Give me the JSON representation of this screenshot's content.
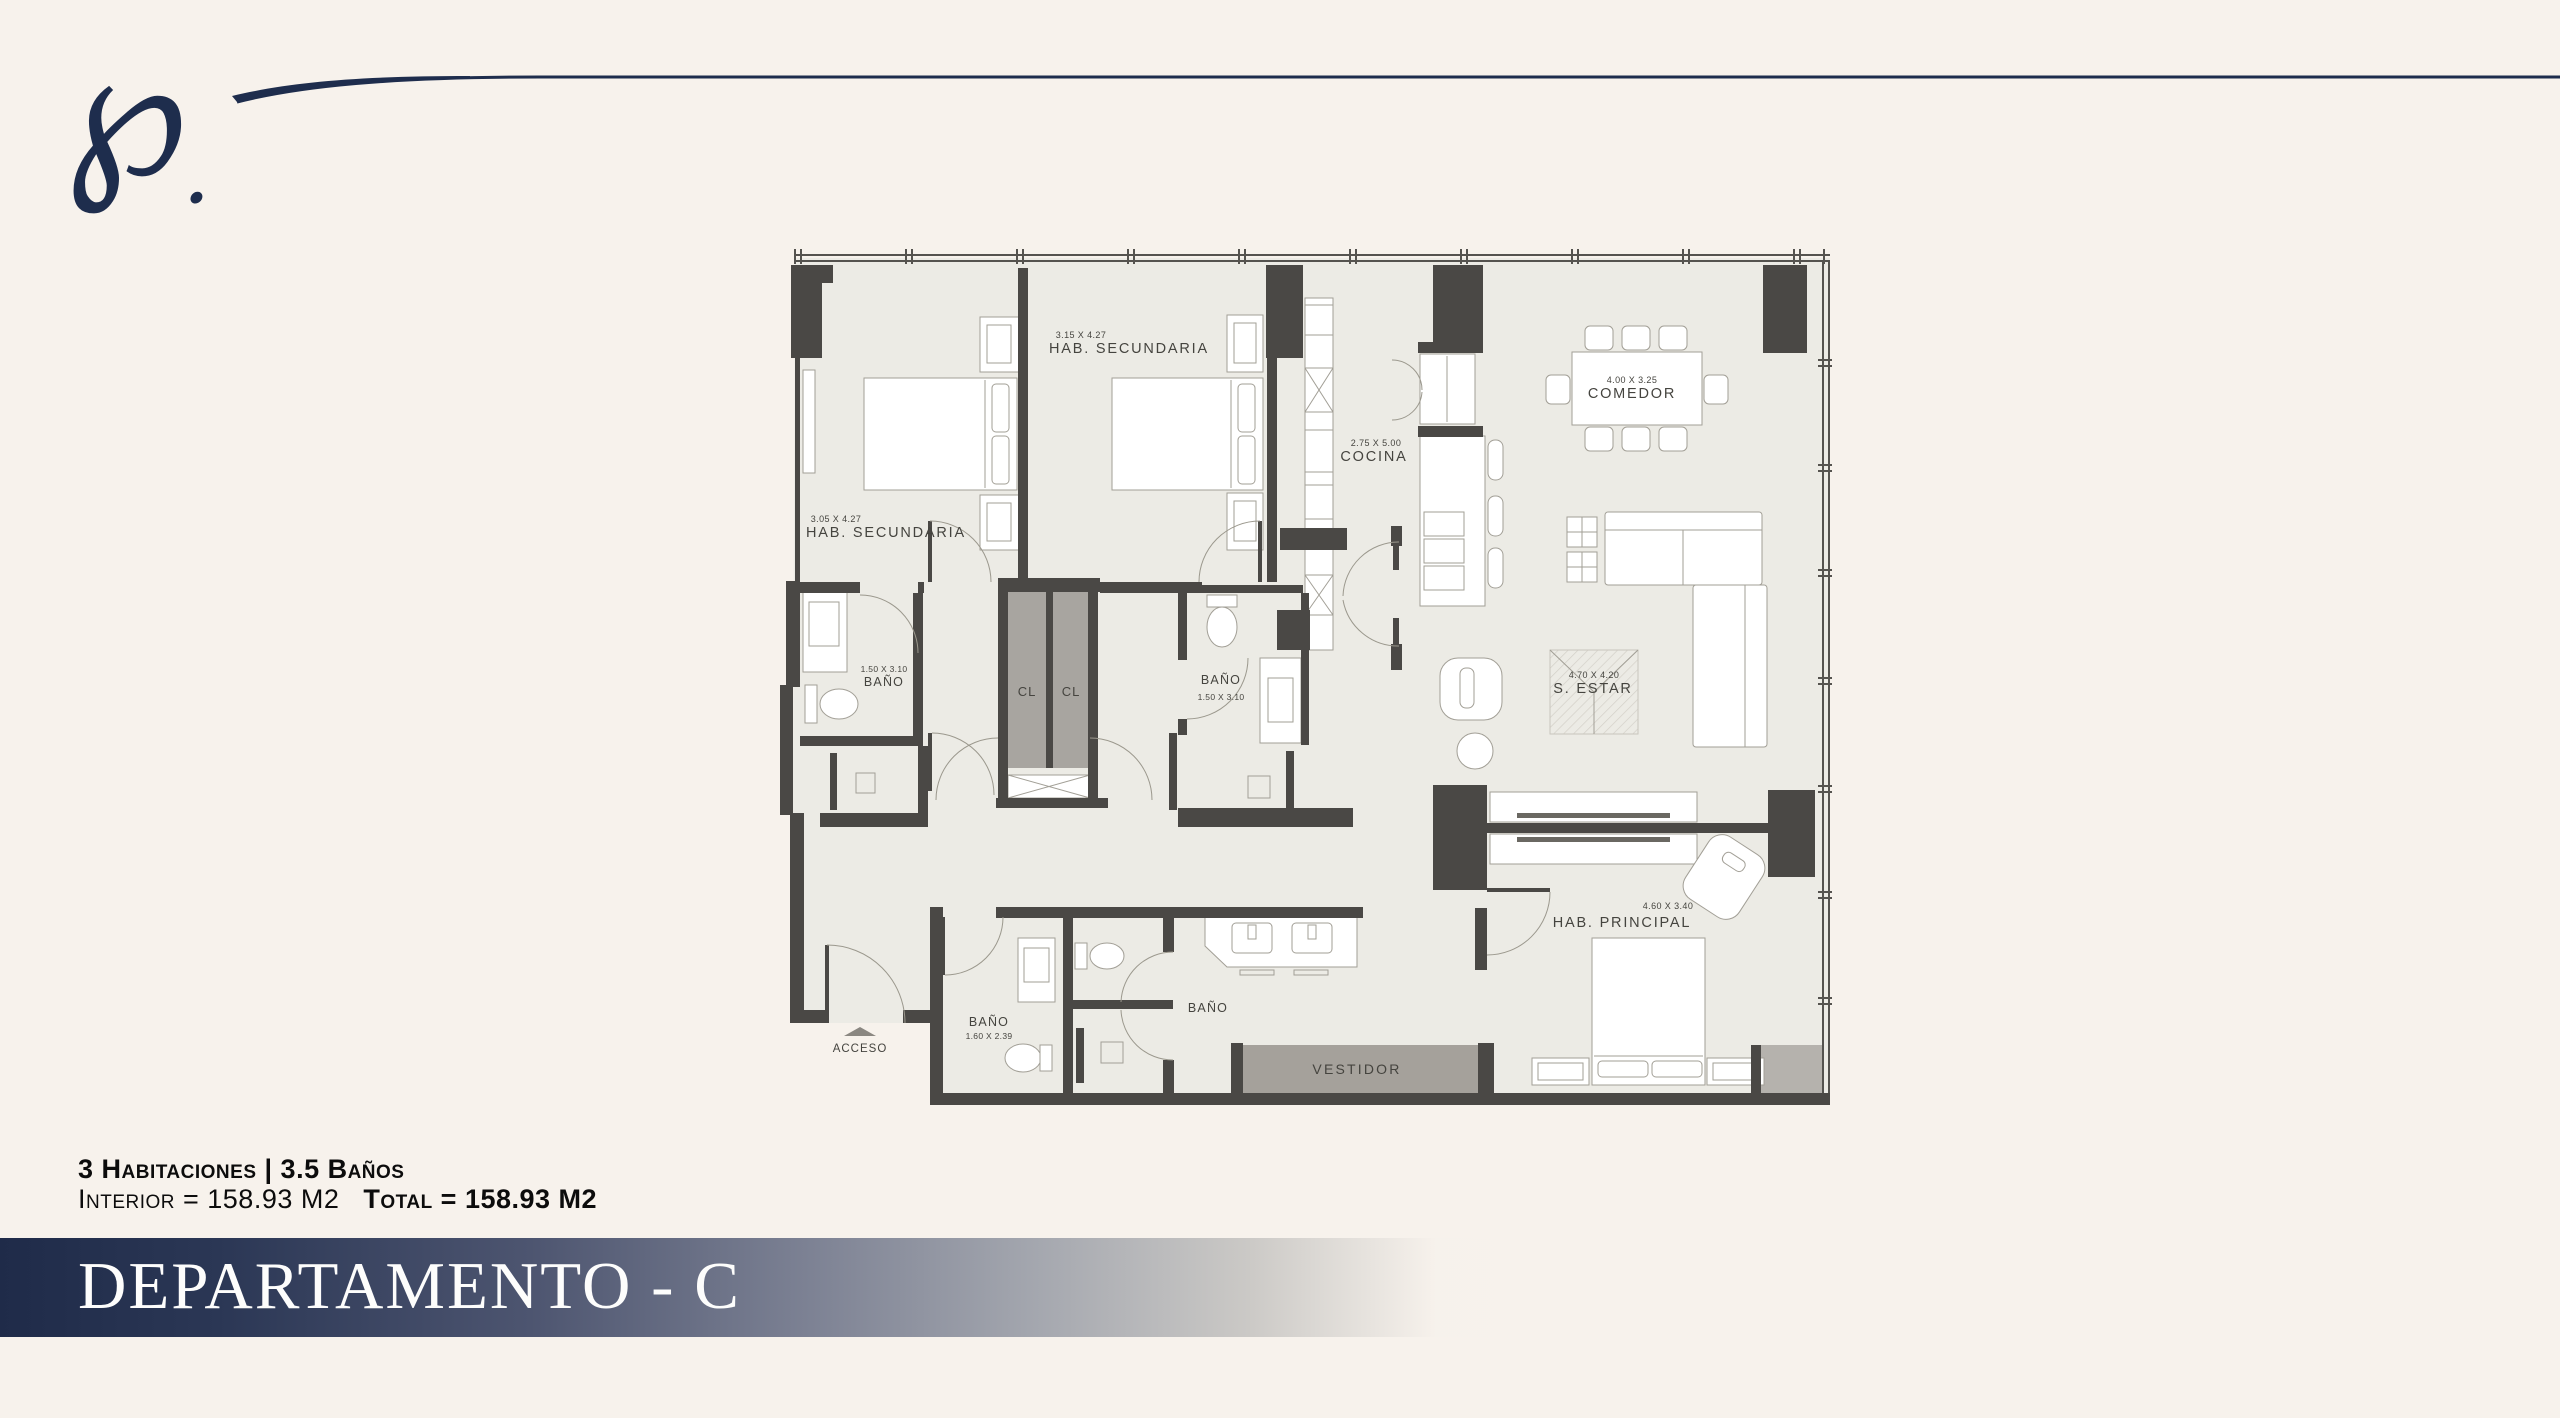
{
  "colors": {
    "background": "#f7f2ec",
    "accent_navy": "#1e2d4d",
    "wall_dark": "#4a4845",
    "floor": "#ecebe5",
    "closet_gray": "#a8a5a0"
  },
  "logo": {
    "glyph": "℘",
    "dot": "."
  },
  "plan": {
    "rooms": {
      "hab_sec_1": {
        "dims": "3.05 X 4.27",
        "name": "HAB. SECUNDARIA"
      },
      "hab_sec_2": {
        "dims": "3.15 X 4.27",
        "name": "HAB. SECUNDARIA"
      },
      "cocina": {
        "dims": "2.75 X 5.00",
        "name": "COCINA"
      },
      "comedor": {
        "dims": "4.00 X 3.25",
        "name": "COMEDOR"
      },
      "s_estar": {
        "dims": "4.70 X 4.20",
        "name": "S. ESTAR"
      },
      "hab_principal": {
        "dims": "4.60 X 3.40",
        "name": "HAB. PRINCIPAL"
      },
      "bano_1": {
        "dims": "1.50 X 3.10",
        "name": "BAÑO"
      },
      "bano_2": {
        "name": "BAÑO",
        "dims": "1.50 X 3.10"
      },
      "bano_3": {
        "name": "BAÑO",
        "dims": "1.60 X 2.39"
      },
      "bano_4": {
        "name": "BAÑO"
      },
      "cl_1": {
        "name": "CL"
      },
      "cl_2": {
        "name": "CL"
      },
      "vestidor": {
        "name": "VESTIDOR"
      },
      "acceso": {
        "name": "ACCESO"
      }
    }
  },
  "stats": {
    "line1": "3 Habitaciones | 3.5 Baños",
    "interior": "Interior = 158.93 M2",
    "total": "Total = 158.93 M2"
  },
  "title": {
    "text": "DEPARTAMENTO - C"
  }
}
